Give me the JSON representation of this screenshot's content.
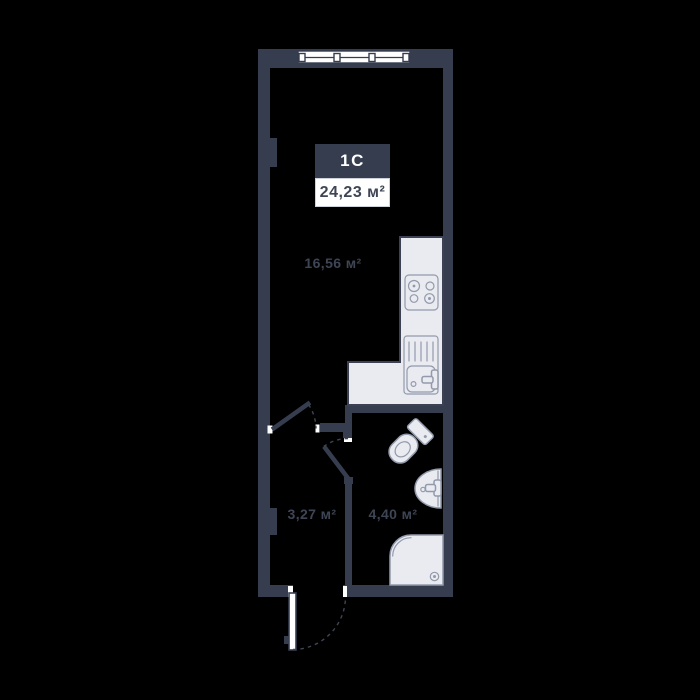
{
  "plan": {
    "unit_label": "1C",
    "total_area": "24,23 м²",
    "rooms": {
      "living": {
        "area": "16,56 м²"
      },
      "hallway": {
        "area": "3,27 м²"
      },
      "bathroom": {
        "area": "4,40 м²"
      }
    }
  },
  "colors": {
    "background": "#000000",
    "wall": "#363D4F",
    "dark_outline": "#3C4254",
    "fixture_fill": "#E9EBF1",
    "fixture_outline": "#929AAB",
    "label_text": "#3E4554",
    "badge_bg": "#363D4F",
    "badge_text": "#FFFFFF",
    "area_box_bg": "#FFFFFF"
  }
}
